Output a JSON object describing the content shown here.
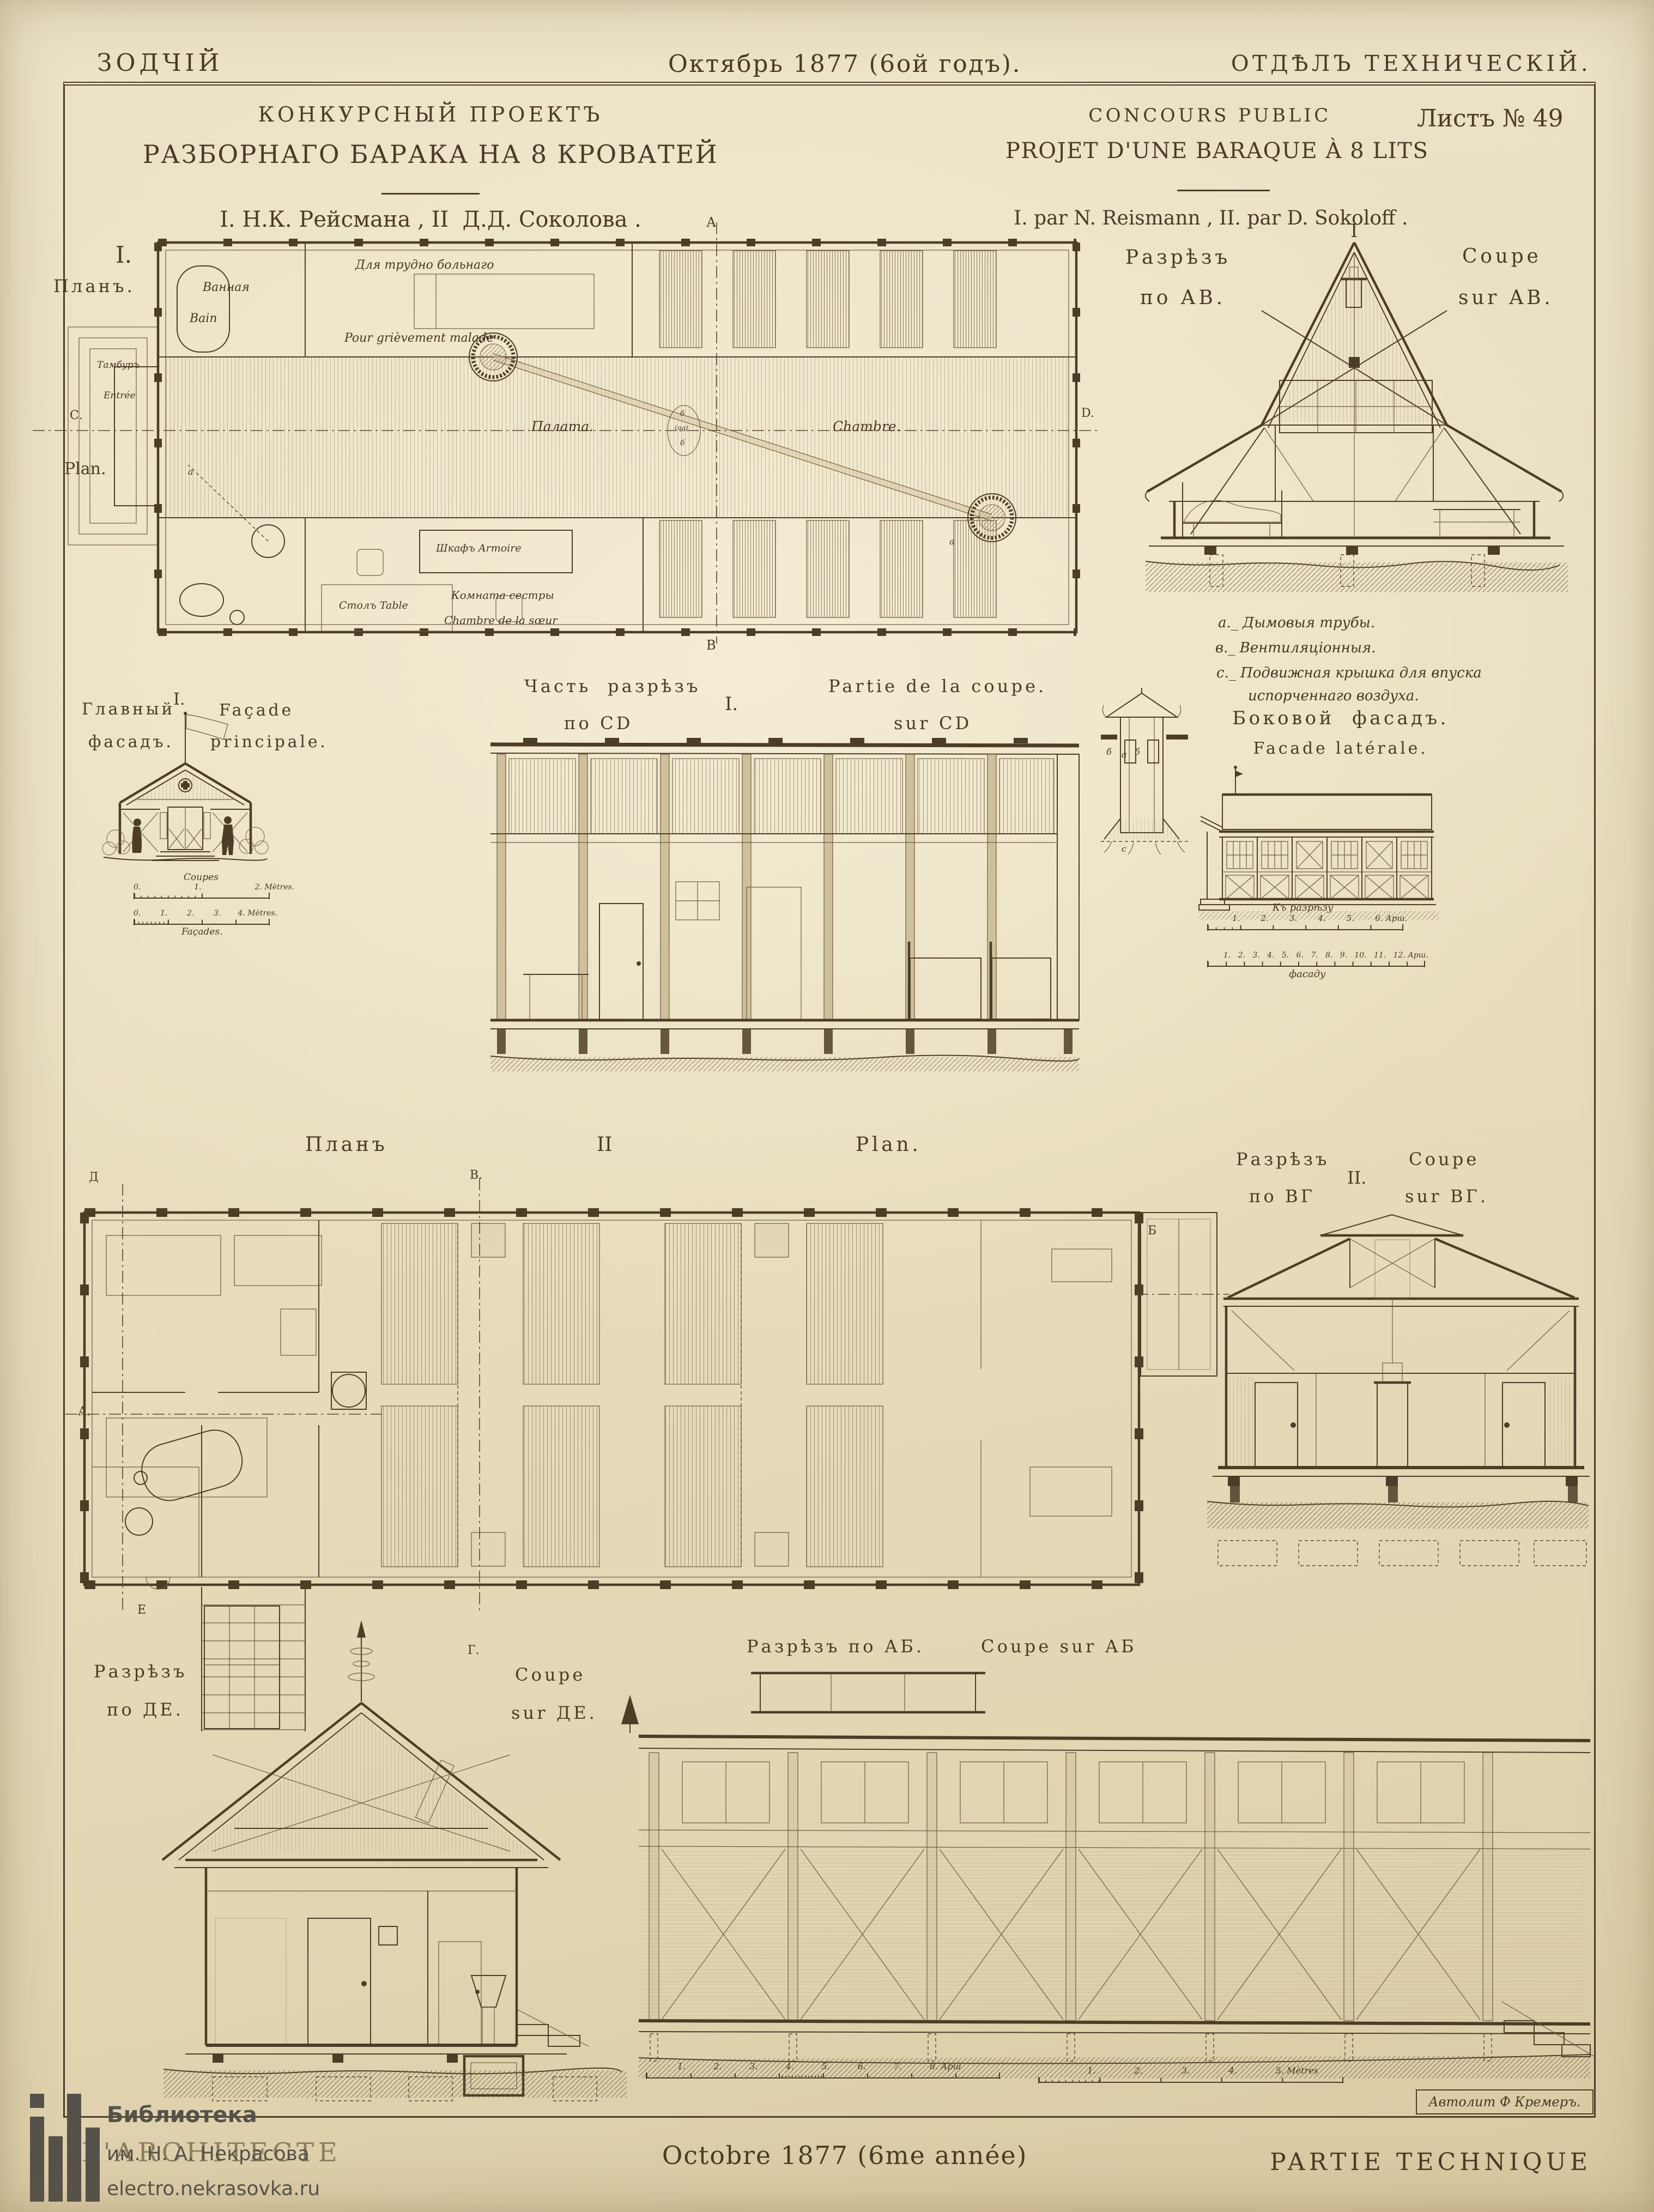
{
  "header": {
    "left": "ЗОДЧІЙ",
    "center": "Октябрь 1877 (6ой годъ).",
    "right": "ОТДѢЛЪ ТЕХНИЧЕСКІЙ."
  },
  "titleblock": {
    "ru1": "КОНКУРСНЫЙ ПРОЕКТЪ",
    "ru2": "РАЗБОРНАГО БАРАКА НА 8 КРОВАТЕЙ",
    "ru3": "I. Н.К. Рейсмана , II  Д.Д. Соколова .",
    "fr1": "CONCOURS PUBLIC",
    "fr2": "PROJET D'UNE BARAQUE À 8 LITS",
    "fr3": "I. par N. Reismann , II. par D. Sokoloff .",
    "sheet": "Листъ № 49"
  },
  "plan1": {
    "numeral": "I.",
    "title_ru": "Планъ.",
    "title_fr": "Plan.",
    "letters": {
      "a_top": "А",
      "b_bottom": "В",
      "c_left": "С.",
      "d_right": "D.",
      "pipe1": "а",
      "pipe2": "а",
      "oval1": "б",
      "oval_mid": "(qq)",
      "oval2": "б"
    },
    "labels": {
      "bath_ru": "Ванная",
      "bath_fr": "Bain",
      "severe_ru": "Для трудно больнаго",
      "severe_fr": "Pour grièvement malade",
      "tambour_ru": "Тамбуръ",
      "tambour_fr": "Entrée",
      "ward_ru": "Палата.",
      "ward_fr": "Chambre.",
      "wardrobe": "Шкафъ Armoire",
      "sister_ru": "Комната сестры",
      "sister_fr": "Chambre de la sœur",
      "table": "Столъ Table"
    }
  },
  "coupe_ab": {
    "title_ru1": "Разрѣзъ",
    "title_ru2": "по АВ.",
    "numeral": "I",
    "title_fr1": "Coupe",
    "title_fr2": "sur AB.",
    "legend1": "a._ Дымовыя трубы.",
    "legend2": "в._ Вентиляціонныя.",
    "legend3": "c._ Подвижная крышка для впуска",
    "legend4": "испорченнаго воздуха."
  },
  "facade_main": {
    "title_ru1": "Главный",
    "title_ru2": "фасадъ.",
    "numeral": "I.",
    "title_fr1": "Façade",
    "title_fr2": "principale.",
    "scale1_top": "Coupes",
    "scale1_ticks": "0.                      1.                      2. Mètres.",
    "scale2_ticks": "0.        1.        2.        3.       4. Mètres.",
    "scale2_bottom": "Façades."
  },
  "coupe_cd": {
    "title_ru1": "Часть  разрѣзъ",
    "title_ru2": "по CD",
    "numeral": "I.",
    "title_fr1": "Partie de la coupe.",
    "title_fr2": "sur CD",
    "tower_b1": "б",
    "tower_a": "а",
    "tower_b2": "б",
    "tower_c": "c"
  },
  "facade_lat": {
    "title_ru": "Боковой  фасадъ.",
    "title_fr": "Facade latérale.",
    "scale1_top": "Къ разрѣзу",
    "scale1_ticks": "1.        2.        3.        4.        5.        6. Арш.",
    "scale2_ticks": "1.   2.   3.   4.   5.   6.   7.   8.   9.   10.   11.   12. Арш.",
    "scale2_bottom": "фасаду"
  },
  "plan2": {
    "title_ru": "Планъ",
    "numeral": "II",
    "title_fr": "Plan.",
    "letters": {
      "d": "Д",
      "v": "В.",
      "a": "А.",
      "e": "Е",
      "g": "Г.",
      "b": "Б"
    }
  },
  "coupe_vg": {
    "title_ru1": "Разрѣзъ",
    "title_ru2": "по ВГ",
    "numeral": "II.",
    "title_fr1": "Coupe",
    "title_fr2": "sur ВГ."
  },
  "coupe_de": {
    "title_ru1": "Разрѣзъ",
    "title_ru2": "по ДЕ.",
    "title_fr1": "Coupe",
    "title_fr2": "sur ДЕ."
  },
  "coupe_ab2": {
    "title_ru": "Разрѣзъ по АБ.",
    "title_fr": "Coupe sur АБ",
    "scale_arsh": "1.          2.          3.          4.          5.          6.          7.          8. Арш",
    "scale_m": "1.              2.              3.              4.              5. Mètres"
  },
  "footer": {
    "left": "L'ARCHITECTE",
    "center": "Octobre 1877 (6me année)",
    "right": "PARTIE TECHNIQUE",
    "litho": "Автолит Ф Кремеръ."
  },
  "watermark": {
    "l1": "Библиотека",
    "l2": "им. Н. А. Некрасова",
    "l3": "electro.nekrasovka.ru"
  }
}
